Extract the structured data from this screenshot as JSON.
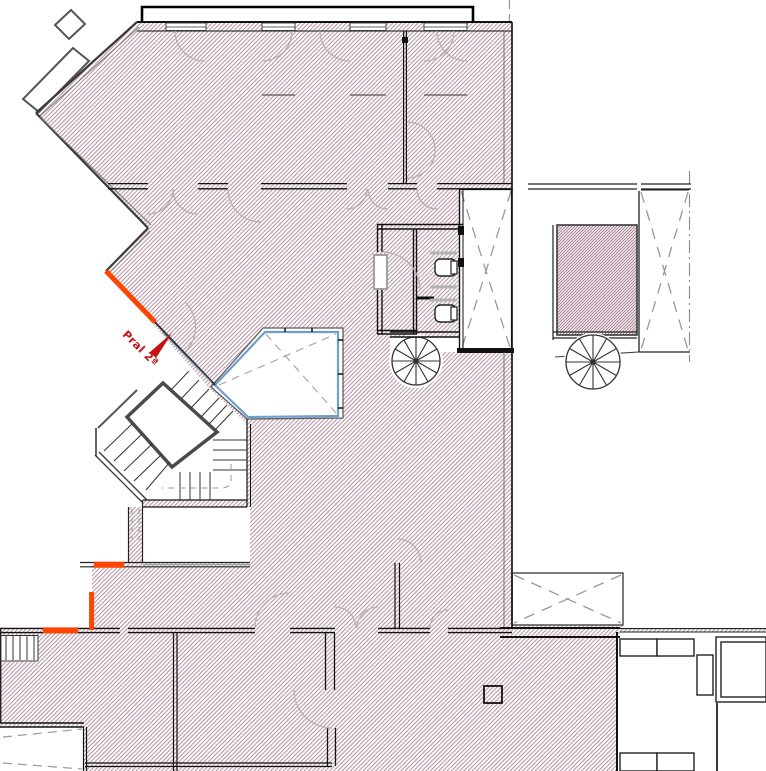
{
  "plan": {
    "label": {
      "text": "Pral 2ª"
    },
    "colors": {
      "hatch_line": "#b28fa0",
      "hatch_dense": "#a57e92",
      "wall_dark": "#1c1c1c",
      "wall_gray": "#555555",
      "highlight_orange": "#ff4500",
      "window_blue": "#6f9fd0",
      "swing_arc_gray": "#b8b0b4",
      "shaft_dash_gray": "#999999",
      "label_red": "#c41111"
    },
    "features": [
      "balcony",
      "bay-window",
      "patio-pentagon",
      "elevator-shaft",
      "light-well",
      "spiral-stair-left",
      "spiral-stair-right",
      "main-staircase",
      "wc-cabins",
      "terrace",
      "porch",
      "ramp",
      "entry-steps",
      "annex-room",
      "furniture",
      "highlighted-walls",
      "door-swings"
    ]
  }
}
